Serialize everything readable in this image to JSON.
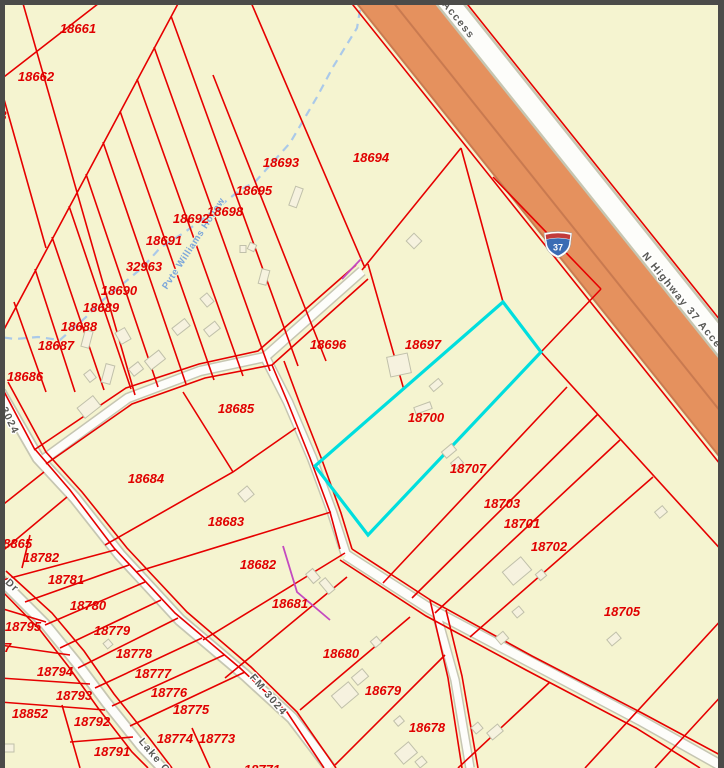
{
  "map": {
    "type": "parcel-map-viewer",
    "selected_parcel": "18700",
    "selection_color": "#00dede"
  },
  "colors": {
    "background": "#f5f4d0",
    "parcel_line": "#e60000",
    "parcel_label": "#e00000",
    "road_fill": "#fdfdfa",
    "road_casing": "#c6c6b2",
    "highway_fill": "#e5915e",
    "highway_casing": "#c97a50",
    "stream": "#aac9e9",
    "stream_label": "#7ba6da",
    "frame_border": "#4b4b49",
    "building_fill": "#f6f2df",
    "building_stroke": "#c0c0aa"
  },
  "highway_shield": {
    "route": "37",
    "x": 558,
    "y": 244
  },
  "parcel_labels": [
    {
      "id": "18661",
      "x": 78,
      "y": 33
    },
    {
      "id": "18662",
      "x": 36,
      "y": 81
    },
    {
      "id": "3",
      "x": 3,
      "y": 120
    },
    {
      "id": "18693",
      "x": 281,
      "y": 167
    },
    {
      "id": "18694",
      "x": 371,
      "y": 162
    },
    {
      "id": "18695",
      "x": 254,
      "y": 195
    },
    {
      "id": "18698",
      "x": 225,
      "y": 216
    },
    {
      "id": "18692",
      "x": 191,
      "y": 223
    },
    {
      "id": "18691",
      "x": 164,
      "y": 245
    },
    {
      "id": "32963",
      "x": 144,
      "y": 271
    },
    {
      "id": "18690",
      "x": 119,
      "y": 295
    },
    {
      "id": "18689",
      "x": 101,
      "y": 312
    },
    {
      "id": "18688",
      "x": 79,
      "y": 331
    },
    {
      "id": "18687",
      "x": 56,
      "y": 350
    },
    {
      "id": "18686",
      "x": 25,
      "y": 381
    },
    {
      "id": "18696",
      "x": 328,
      "y": 349
    },
    {
      "id": "18697",
      "x": 423,
      "y": 349
    },
    {
      "id": "18700",
      "x": 426,
      "y": 422
    },
    {
      "id": "18707",
      "x": 468,
      "y": 473
    },
    {
      "id": "18703",
      "x": 502,
      "y": 508
    },
    {
      "id": "18701",
      "x": 522,
      "y": 528
    },
    {
      "id": "18702",
      "x": 549,
      "y": 551
    },
    {
      "id": "18705",
      "x": 622,
      "y": 616
    },
    {
      "id": "18685",
      "x": 236,
      "y": 413
    },
    {
      "id": "18684",
      "x": 146,
      "y": 483
    },
    {
      "id": "18683",
      "x": 226,
      "y": 526
    },
    {
      "id": "18682",
      "x": 258,
      "y": 569
    },
    {
      "id": "18681",
      "x": 290,
      "y": 608
    },
    {
      "id": "18680",
      "x": 341,
      "y": 658
    },
    {
      "id": "18679",
      "x": 383,
      "y": 695
    },
    {
      "id": "18678",
      "x": 427,
      "y": 732
    },
    {
      "id": "18865",
      "x": 14,
      "y": 548
    },
    {
      "id": "18782",
      "x": 41,
      "y": 562
    },
    {
      "id": "18781",
      "x": 66,
      "y": 584
    },
    {
      "id": "18780",
      "x": 88,
      "y": 610
    },
    {
      "id": "18795",
      "x": 23,
      "y": 631
    },
    {
      "id": "07",
      "x": 4,
      "y": 652
    },
    {
      "id": "18779",
      "x": 112,
      "y": 635
    },
    {
      "id": "18778",
      "x": 134,
      "y": 658
    },
    {
      "id": "18777",
      "x": 153,
      "y": 678
    },
    {
      "id": "18776",
      "x": 169,
      "y": 697
    },
    {
      "id": "18775",
      "x": 191,
      "y": 714
    },
    {
      "id": "18774",
      "x": 175,
      "y": 743
    },
    {
      "id": "18773",
      "x": 217,
      "y": 743
    },
    {
      "id": "18794",
      "x": 55,
      "y": 676
    },
    {
      "id": "18793",
      "x": 74,
      "y": 700
    },
    {
      "id": "18852",
      "x": 30,
      "y": 718
    },
    {
      "id": "18792",
      "x": 92,
      "y": 726
    },
    {
      "id": "18791",
      "x": 112,
      "y": 756
    },
    {
      "id": "18771",
      "x": 262,
      "y": 774
    }
  ],
  "road_labels": [
    {
      "text": "3024",
      "x": 7,
      "y": 422,
      "rot": 64
    },
    {
      "text": "FM 3024",
      "x": 266,
      "y": 697,
      "rot": 49
    },
    {
      "text": "Dr",
      "x": 10,
      "y": 588,
      "rot": 43
    },
    {
      "text": "Lake C",
      "x": 152,
      "y": 758,
      "rot": 50
    },
    {
      "text": "Access",
      "x": 456,
      "y": 22,
      "rot": 51
    },
    {
      "text": "N Highway 37 Access",
      "x": 684,
      "y": 308,
      "rot": 51
    }
  ],
  "water_label": {
    "text": "Pvte Williams Hollow",
    "x": 196,
    "y": 245,
    "rot": -57
  }
}
